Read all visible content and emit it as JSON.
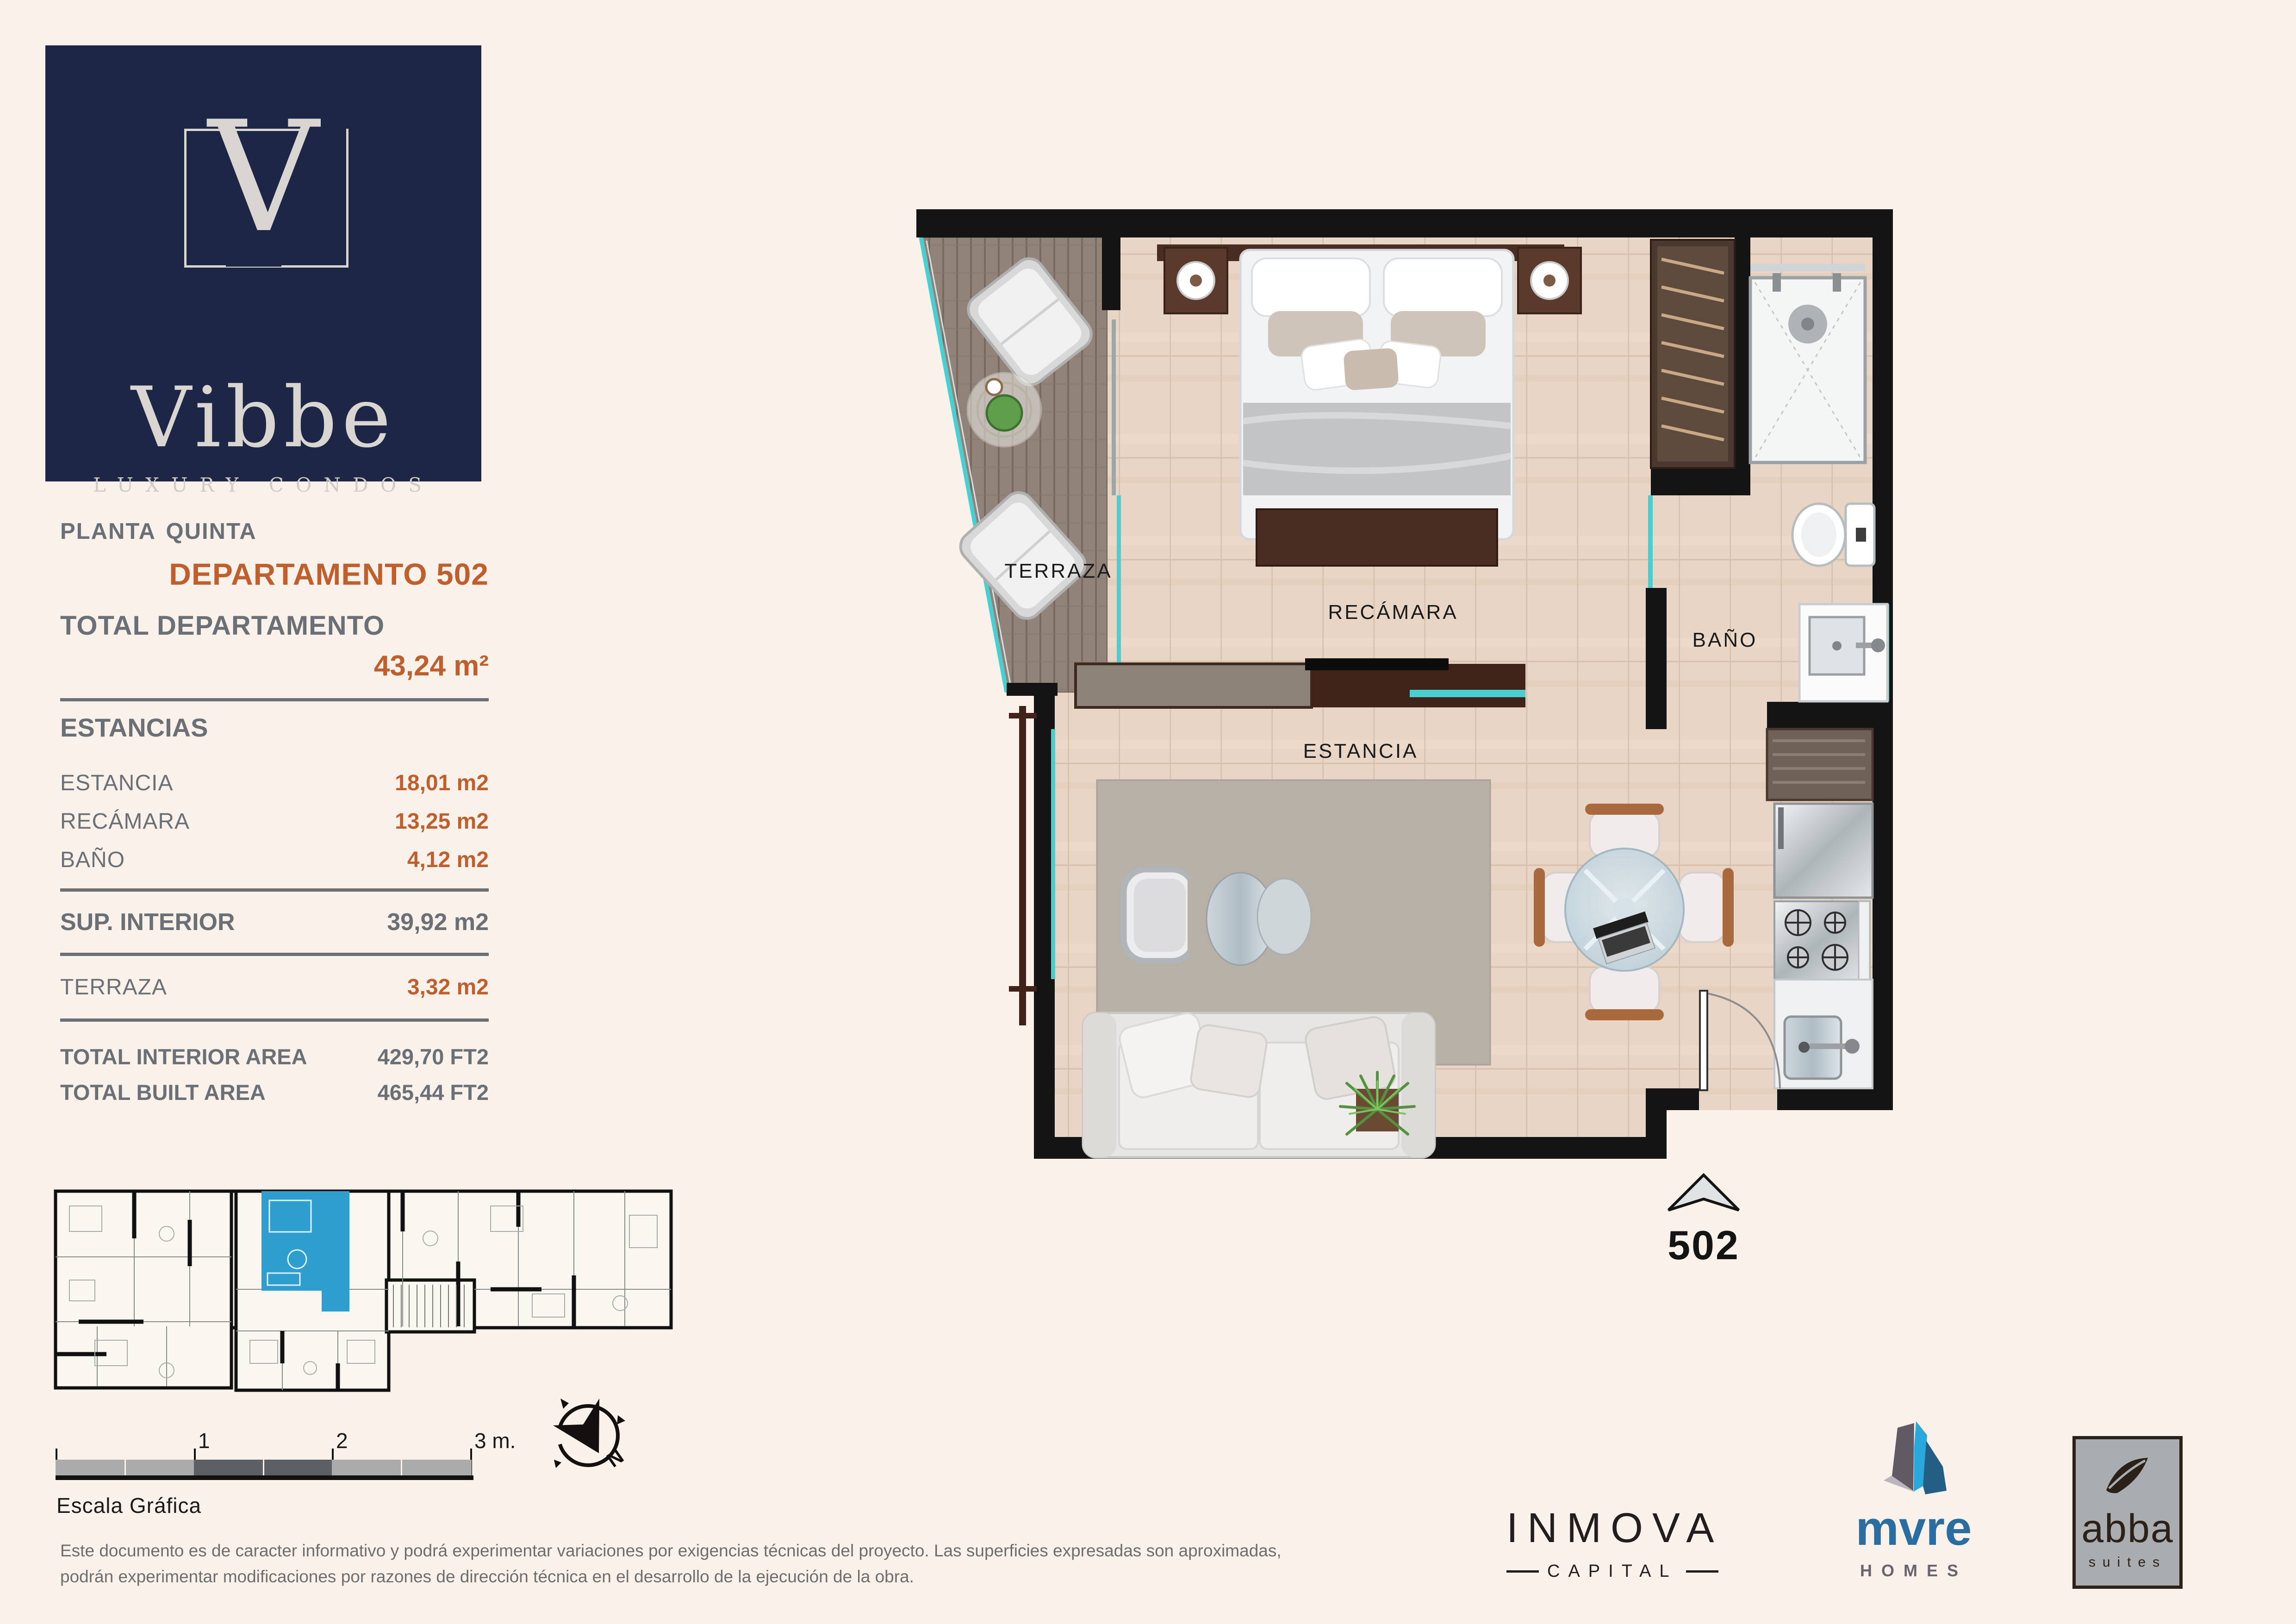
{
  "brand": {
    "initial": "V",
    "name": "Vibbe",
    "tagline": "LUXURY CONDOS"
  },
  "header": {
    "floor": "Planta Quinta",
    "unit": "DEPARTAMENTO 502"
  },
  "summary": {
    "total_label": "TOTAL DEPARTAMENTO",
    "total_value": "43,24 m²",
    "estancias_label": "ESTANCIAS"
  },
  "rooms": [
    {
      "label": "ESTANCIA",
      "value": "18,01 m2"
    },
    {
      "label": "RECÁMARA",
      "value": "13,25 m2"
    },
    {
      "label": "BAÑO",
      "value": "4,12 m2"
    }
  ],
  "interior": {
    "label": "SUP. INTERIOR",
    "value": "39,92 m2"
  },
  "terrace": {
    "label": "TERRAZA",
    "value": "3,32 m2"
  },
  "totals": [
    {
      "label": "TOTAL INTERIOR AREA",
      "value": "429,70 FT2"
    },
    {
      "label": "TOTAL BUILT AREA",
      "value": "465,44 FT2"
    }
  ],
  "plan": {
    "labels": {
      "terraza": "TERRAZA",
      "recamara": "RECÁMARA",
      "bano": "BAÑO",
      "estancia": "ESTANCIA"
    },
    "unit_marker": "502"
  },
  "scalebar": {
    "ticks": [
      "1",
      "2",
      "3 m."
    ],
    "caption": "Escala Gráfica"
  },
  "compass": {
    "north": "N"
  },
  "disclaimer": {
    "line1": "Este documento es de caracter informativo y podrá experimentar variaciones por exigencias técnicas del proyecto. Las superficies expresadas son aproximadas,",
    "line2": "podrán experimentar modificaciones por razones de dirección técnica en el desarrollo de la ejecución de la obra."
  },
  "partners": [
    {
      "name": "INMOVA",
      "sub": "CAPITAL"
    },
    {
      "name": "mvre",
      "sub": "HOMES"
    },
    {
      "name": "abba",
      "sub": "suites"
    }
  ],
  "colors": {
    "navy": "#1d2646",
    "accent_orange": "#bf5f2d",
    "text_gray": "#6a7076",
    "teal_glass": "#49cfd2",
    "unit_highlight_blue": "#2e9ecf",
    "wall_black": "#141414"
  }
}
